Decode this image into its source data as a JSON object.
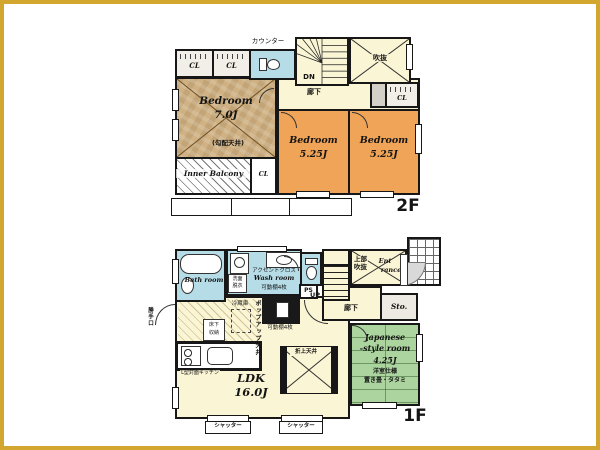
{
  "colors": {
    "frame_gold": "#d2a62f",
    "wall_black": "#171717",
    "floor_cream": "#faf5d4",
    "bedroom_orange": "#f0a458",
    "bedroom_tan": "#cfb184",
    "wet_area_blue": "#b5dce7",
    "tatami_green": "#abd49e",
    "closet_gray": "#f1efe7"
  },
  "floor2": {
    "label": "2F",
    "counter": "カウンター",
    "closet_a": "CL",
    "closet_b": "CL",
    "closet_hall": "CL",
    "closet_balcony": "CL",
    "stairs_down": "DN",
    "void": "吹抜",
    "hallway": "廊下",
    "bedroom_main": {
      "name": "Bedroom",
      "size": "7.0J",
      "ceiling_note": "(勾配天井)"
    },
    "bedroom_a": {
      "name": "Bedroom",
      "size": "5.25J"
    },
    "bedroom_b": {
      "name": "Bedroom",
      "size": "5.25J"
    },
    "inner_balcony": "Inner Balcony"
  },
  "floor1": {
    "label": "1F",
    "bath": "Bath room",
    "wash": {
      "accent": "アクセントクロス",
      "name": "Wash room",
      "shelves": "可動棚4枚",
      "vanity": "洗面脱衣"
    },
    "pipe_space": "PS",
    "stairs_up": "UP",
    "upper_void": "上部吹抜",
    "entrance_line1": "Ent",
    "entrance_line2": "rance",
    "hallway": "廊下",
    "storage": "Sto.",
    "japanese_room": {
      "name_line1": "Japanese",
      "name_line2": "-style room",
      "size": "4.25J",
      "note_spec": "洋室仕様",
      "note_tatami": "置き畳・タタミ"
    },
    "ldk": {
      "name": "LDK",
      "size": "16.0J"
    },
    "kitchen": {
      "popup_ceiling": "ポップアップ天井",
      "underfloor_storage": "床下収納",
      "refrigerator": "冷蔵庫",
      "layout": "L型対面キッチン",
      "pantry_shelves": "可動棚4枚",
      "back_door": "勝手口"
    },
    "coffered_ceiling": "折上天井",
    "shutter_a": "シャッター",
    "shutter_b": "シャッター"
  }
}
